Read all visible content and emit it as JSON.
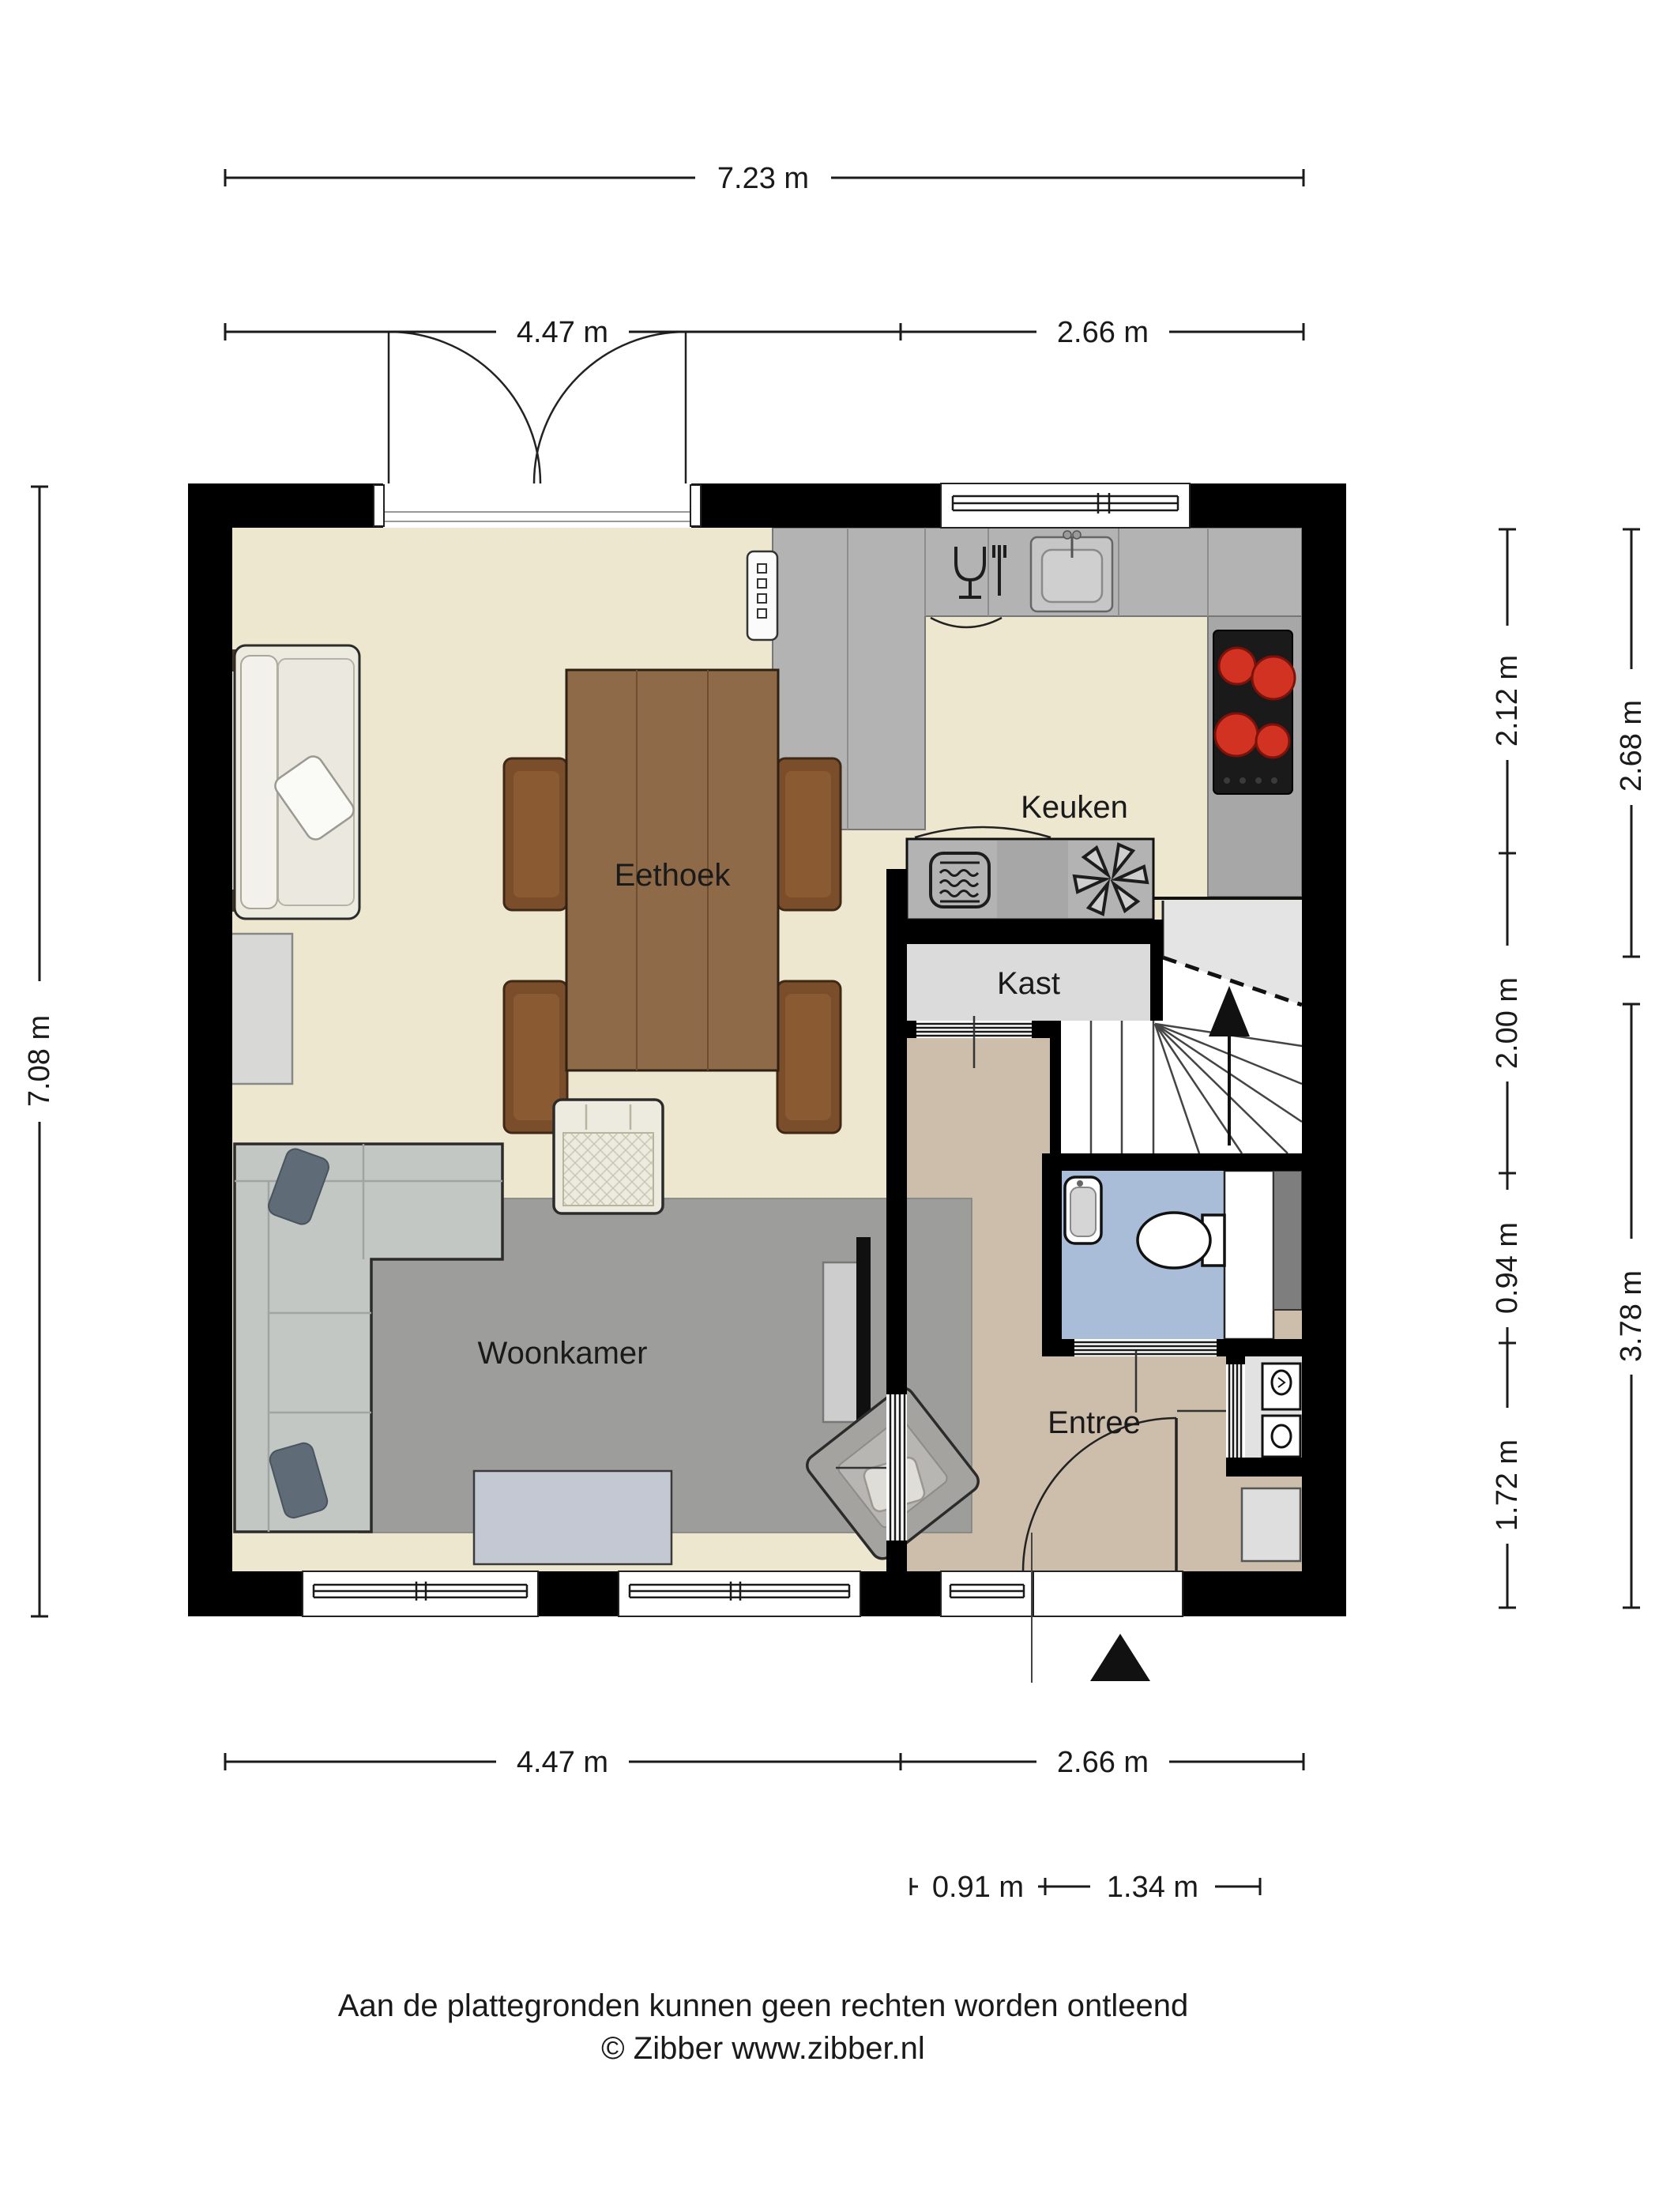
{
  "title": "Begane grond plattegrond",
  "colors": {
    "wall": "#000000",
    "floor": "#EEE7D0",
    "entree": "#CDBDAB",
    "toilet": "#A9BDD9",
    "kast": "#DBDBDB",
    "stair_upper": "#E4E4E4",
    "counter": "#B3B3B3",
    "counter_dark": "#A7A7A7",
    "rug": "#9D9D9B",
    "sofa": "#C2C7C3",
    "pillow": "#5F6B77",
    "wood": "#8E6A49",
    "chair": "#7B4E2B",
    "armchair": "#EDEADF",
    "fauteuil": "#A4A3A0",
    "tv_console": "#CDCDCD",
    "coffee_table": "#C3C8D2",
    "side_table": "#D8D8D6",
    "mat": "#DEDEDE",
    "shaft": "#7E7E7E",
    "cooktop": "#1A1A1A",
    "burner": "#D23222"
  },
  "rooms": {
    "keuken": "Keuken",
    "eethoek": "Eethoek",
    "kast": "Kast",
    "woonkamer": "Woonkamer",
    "entree": "Entree"
  },
  "dimensions": {
    "top_total": "7.23 m",
    "top_left": "4.47 m",
    "top_right": "2.66 m",
    "left_total": "7.08 m",
    "right_inner": [
      "2.12 m",
      "2.00 m",
      "0.94 m",
      "1.72 m"
    ],
    "right_outer": [
      "2.68 m",
      "3.78 m"
    ],
    "bottom_left": "4.47 m",
    "bottom_right": "2.66 m",
    "bottom_small_left": "0.91 m",
    "bottom_small_right": "1.34 m"
  },
  "footer": {
    "disclaimer": "Aan de plattegronden kunnen geen rechten worden ontleend",
    "copyright": "© Zibber www.zibber.nl"
  }
}
